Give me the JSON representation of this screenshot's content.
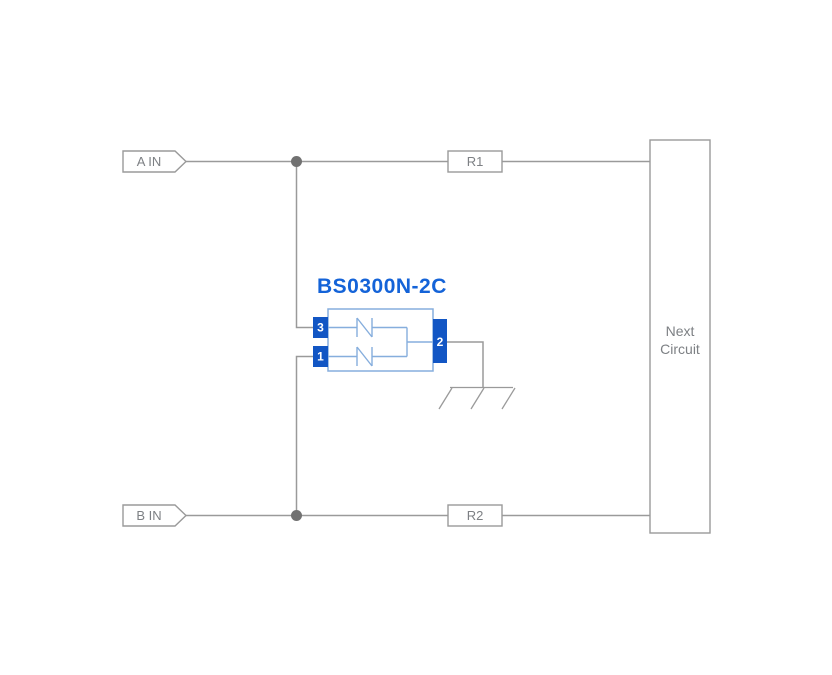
{
  "diagram": {
    "component": {
      "title": "BS0300N-2C",
      "pin_top_left": "3",
      "pin_bottom_left": "1",
      "pin_right": "2"
    },
    "input_a": {
      "label": "A IN"
    },
    "input_b": {
      "label": "B IN"
    },
    "resistor_top": {
      "label": "R1"
    },
    "resistor_bottom": {
      "label": "R2"
    },
    "next_circuit": {
      "line1": "Next",
      "line2": "Circuit"
    }
  },
  "icons": {
    "ground": "chassis-ground-icon",
    "junction_a": "junction-dot",
    "junction_b": "junction-dot",
    "input_tag": "signal-input-tag"
  },
  "colors": {
    "background": "#ffffff",
    "wire": "#9a9a9a",
    "junction": "#717171",
    "label_text": "#7d8084",
    "component_blue": "#1463d8",
    "pin_fill": "#1256c4",
    "body_outline": "#86aedd",
    "pin_text": "#ffffff"
  }
}
